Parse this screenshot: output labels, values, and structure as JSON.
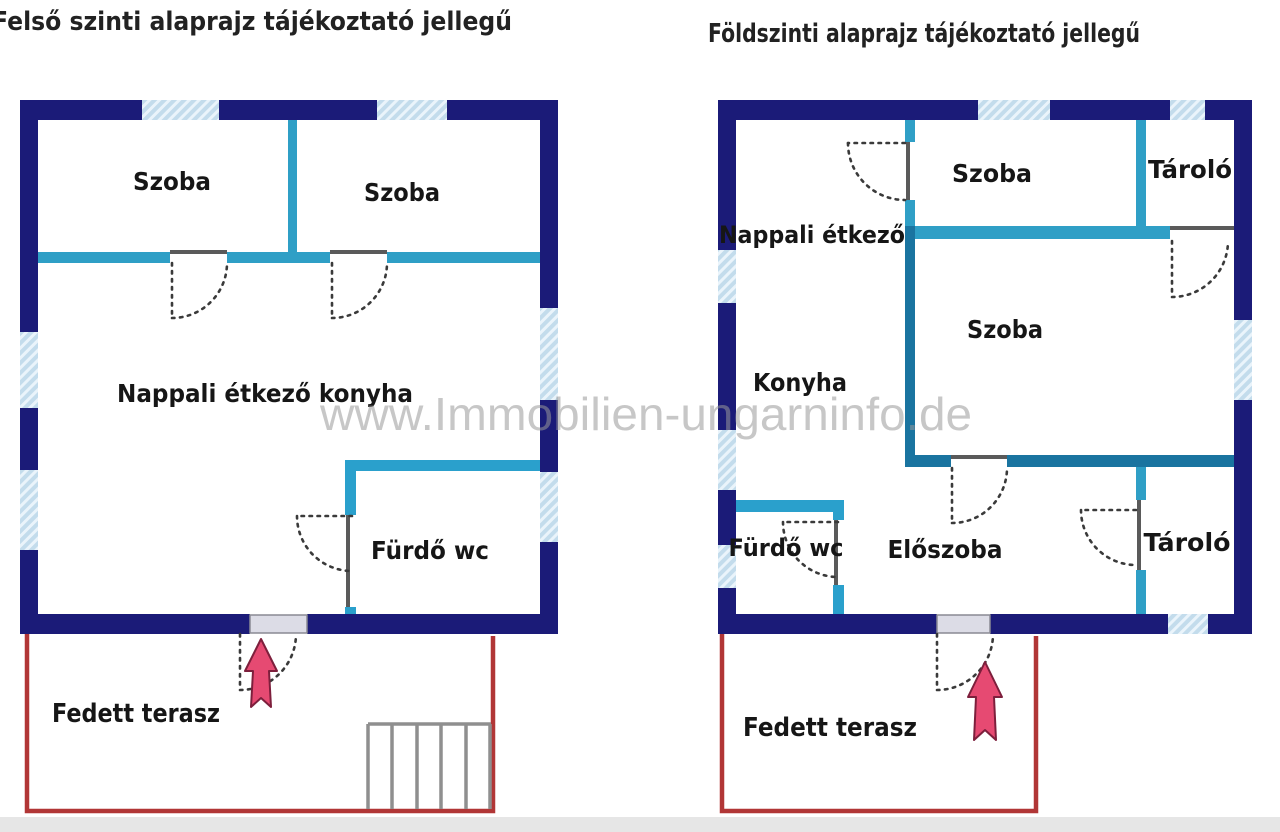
{
  "titles": {
    "upper_floor": "Felső szinti alaprajz tájékoztató jellegű",
    "ground_floor": "Földszinti alaprajz tájékoztató jellegű"
  },
  "watermark": "www.Immobilien-ungarninfo.de",
  "upper_floor": {
    "labels": {
      "szoba_1": "Szoba",
      "szoba_2": "Szoba",
      "nappali": "Nappali étkező konyha",
      "furdo": "Fürdő wc",
      "terasz": "Fedett terasz"
    }
  },
  "ground_floor": {
    "labels": {
      "nappali": "Nappali étkező",
      "szoba_top": "Szoba",
      "tarolo_top": "Tároló",
      "szoba": "Szoba",
      "konyha": "Konyha",
      "furdo": "Fürdő wc",
      "eloszoba": "Előszoba",
      "tarolo_bottom": "Tároló",
      "terasz": "Fedett terasz"
    }
  },
  "colors": {
    "outer_wall": "#1b1b78",
    "interior_wall": "#2f9fc6",
    "interior_wall_dark": "#1a74a0",
    "window_fill": "#c3dcec",
    "terrace_outline": "#b13636",
    "stairs": "#8f8f8f",
    "entrance_arrow": "#e64a72",
    "door_arc": "#3a3a3a",
    "title_text": "#222222",
    "watermark_text": "#9a9a9a"
  }
}
